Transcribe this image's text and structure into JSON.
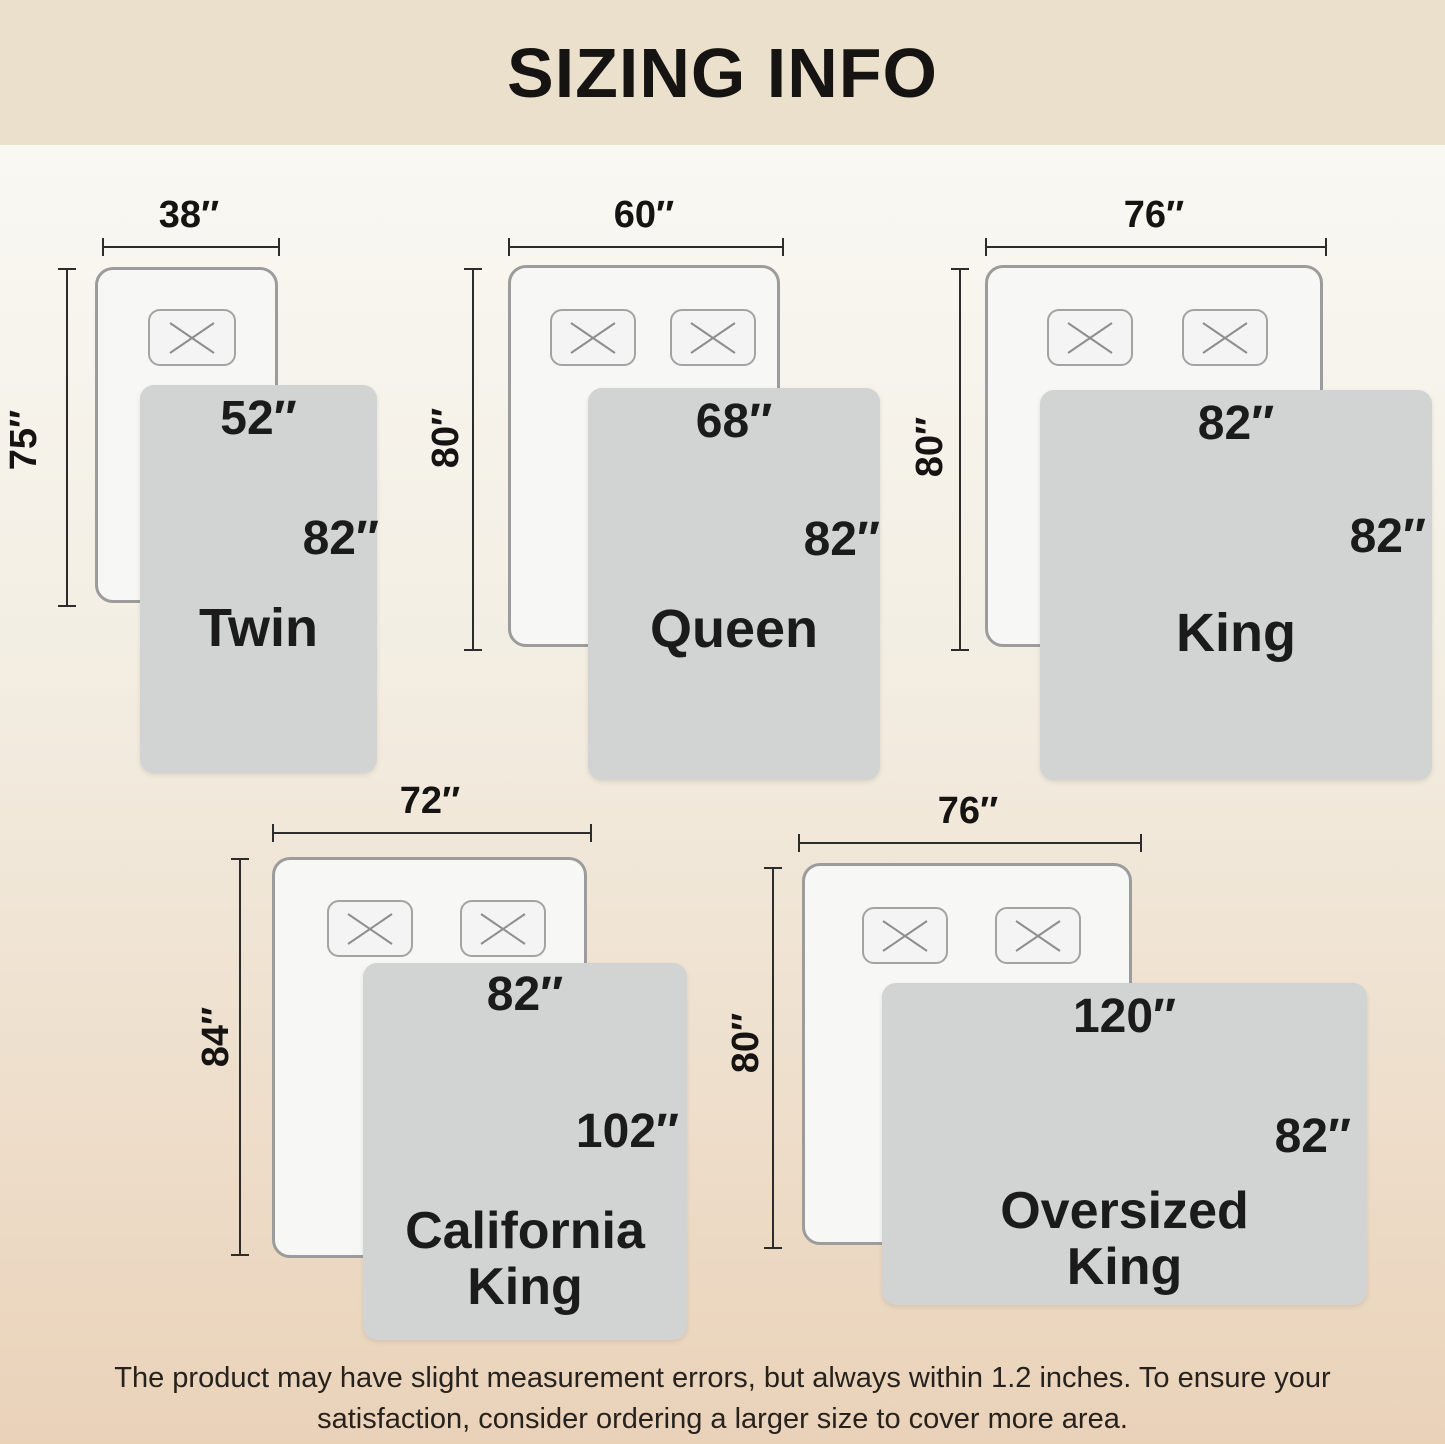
{
  "title": "SIZING INFO",
  "note": {
    "line1": "The product may have slight measurement errors, but always within 1.2 inches. To ensure your",
    "line2": "satisfaction, consider ordering a larger size to cover more area."
  },
  "sizes": [
    {
      "name": "Twin",
      "name_line1": "Twin",
      "bed_width": "38″",
      "bed_length": "75″",
      "blanket_width": "52″",
      "blanket_length": "82″",
      "pillow_count": 1
    },
    {
      "name": "Queen",
      "name_line1": "Queen",
      "bed_width": "60″",
      "bed_length": "80″",
      "blanket_width": "68″",
      "blanket_length": "82″",
      "pillow_count": 2
    },
    {
      "name": "King",
      "name_line1": "King",
      "bed_width": "76″",
      "bed_length": "80″",
      "blanket_width": "82″",
      "blanket_length": "82″",
      "pillow_count": 2
    },
    {
      "name": "California King",
      "name_line1": "California",
      "name_line2": "King",
      "bed_width": "72″",
      "bed_length": "84″",
      "blanket_width": "82″",
      "blanket_length": "102″",
      "pillow_count": 2
    },
    {
      "name": "Oversized King",
      "name_line1": "Oversized",
      "name_line2": "King",
      "bed_width": "76″",
      "bed_length": "80″",
      "blanket_width": "120″",
      "blanket_length": "82″",
      "pillow_count": 2
    }
  ],
  "icons": {
    "pillow_cross": "pillow-cross-icon"
  },
  "colors": {
    "header_bg": "#eae0cc",
    "background_top": "#f9f8f3",
    "background_bottom": "#ead2b9",
    "bed_fill": "#f7f7f6",
    "bed_border": "#9c9c9c",
    "pillow_border": "#a3a3a3",
    "pillow_cross": "#8e8e8e",
    "blanket_fill": "#d2d3d3",
    "dimension_line": "#2c2c2c",
    "text_ink": "#1b1b1b"
  }
}
